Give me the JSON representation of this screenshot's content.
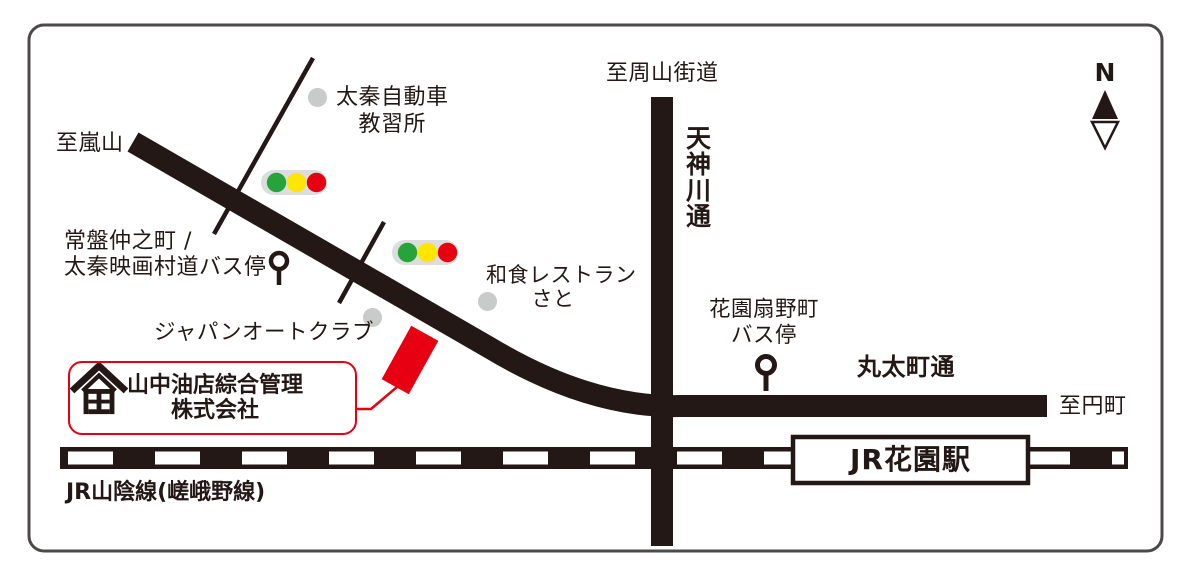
{
  "colors": {
    "ink": "#231815",
    "accent_red": "#e60012",
    "dot_gray": "#c9caca",
    "signal_bg": "#dcdddd",
    "signal_green": "#27a439",
    "signal_yellow": "#ffe600",
    "signal_red": "#e60012",
    "border_gray": "#4c4948"
  },
  "compass": {
    "north_label": "N"
  },
  "roads": {
    "to_arashiyama": "至嵐山",
    "to_shuzan_kaido": "至周山街道",
    "tenjingawa_dori": "天神川通",
    "marutamachi_dori": "丸太町通",
    "to_enmachi": "至円町",
    "jr_sanin_line": "JR山陰線(嵯峨野線)"
  },
  "station": {
    "name": "JR花園駅"
  },
  "landmarks": {
    "driving_school": {
      "line1": "太秦自動車",
      "line2": "教習所"
    },
    "tokiwa_bus_stop": {
      "line1": "常盤仲之町 /",
      "line2": "太秦映画村道バス停"
    },
    "japan_auto_club": {
      "name": "ジャパンオートクラブ"
    },
    "washoku_sato": {
      "line1": "和食レストラン",
      "line2": "さと"
    },
    "hanazono_bus_stop": {
      "line1": "花園扇野町",
      "line2": "バス停"
    }
  },
  "company": {
    "name_line1": "山中油店綜合管理",
    "name_line2": "株式会社"
  }
}
